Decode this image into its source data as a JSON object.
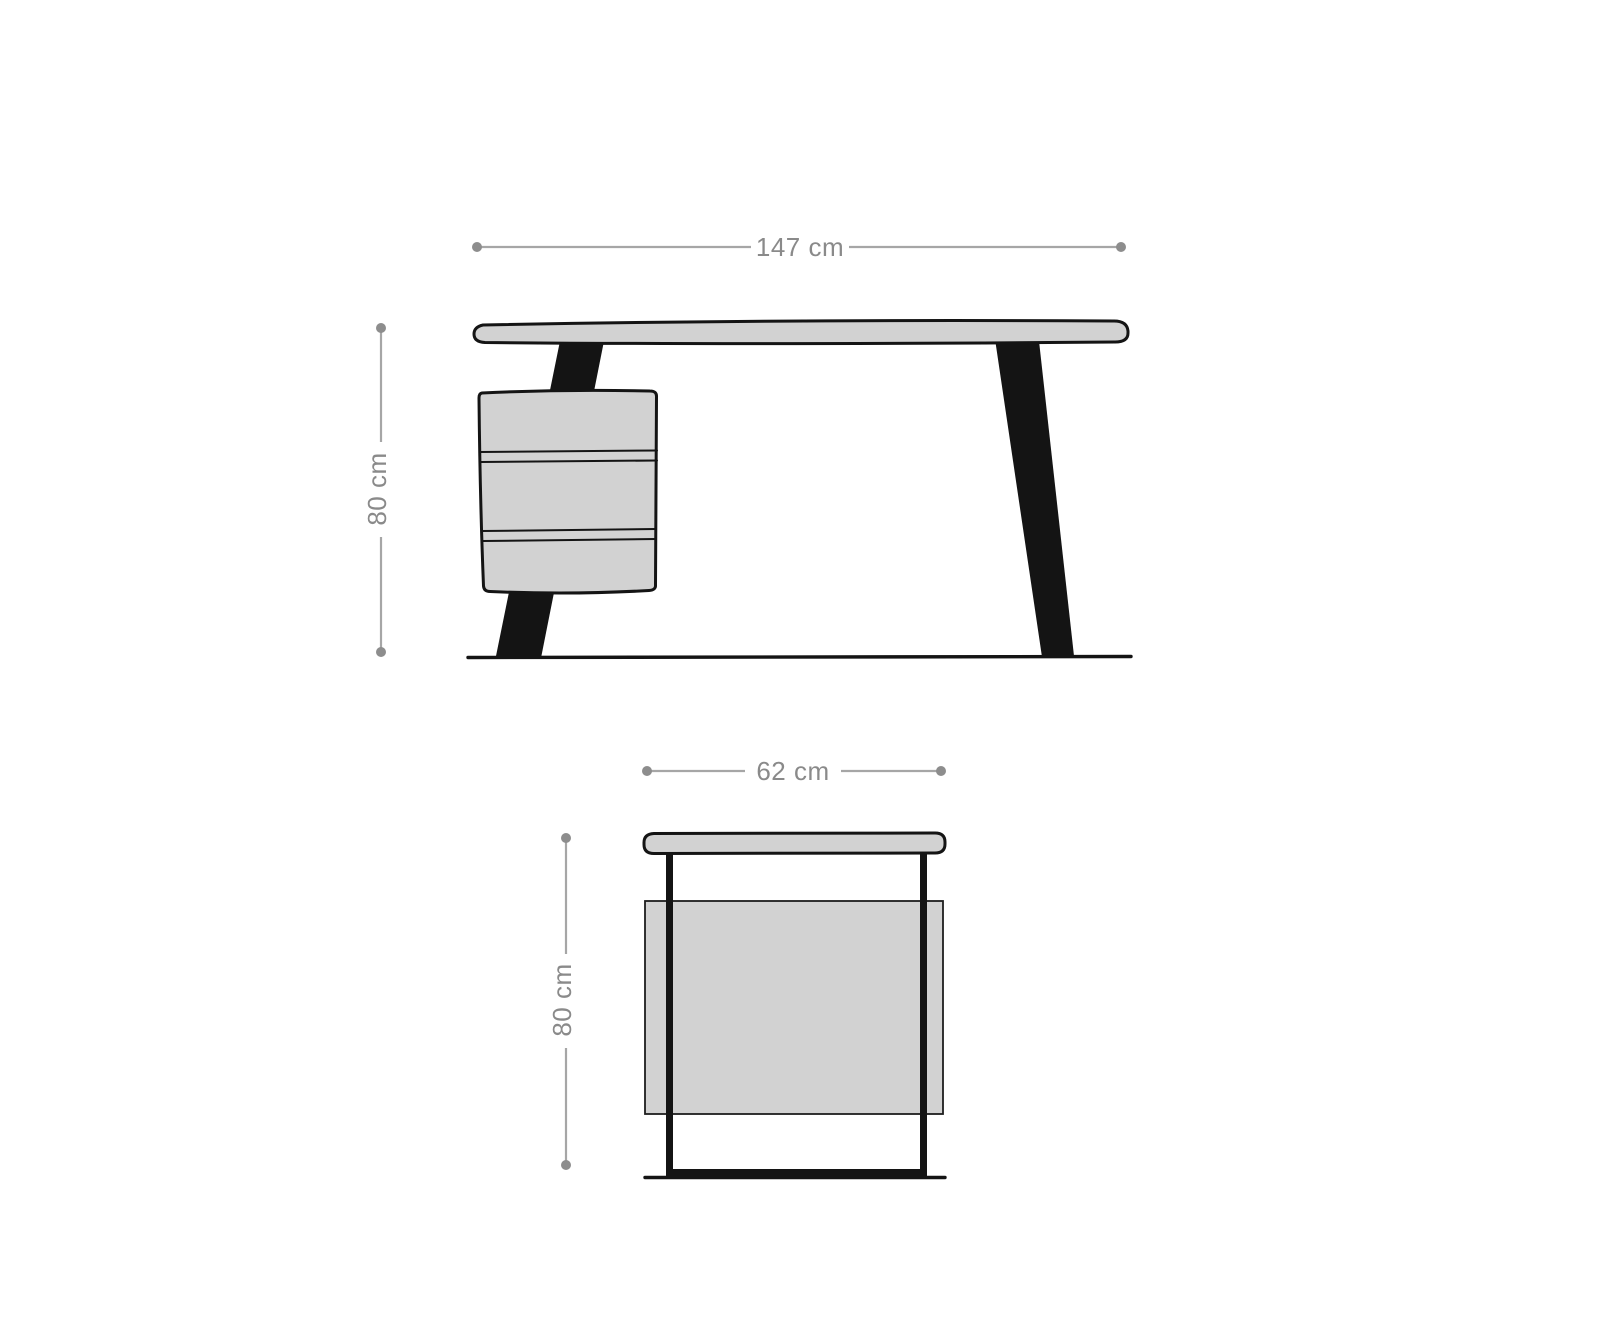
{
  "colors": {
    "background": "#ffffff",
    "furniture_fill": "#d2d2d2",
    "leg_fill": "#141414",
    "dimension_line": "#a6a6a6",
    "dimension_dot": "#8d8d8d",
    "dimension_text": "#8a8a8a"
  },
  "front_view": {
    "width_label": "147 cm",
    "height_label": "80 cm",
    "drawer_count": 3
  },
  "side_view": {
    "width_label": "62 cm",
    "height_label": "80 cm"
  }
}
